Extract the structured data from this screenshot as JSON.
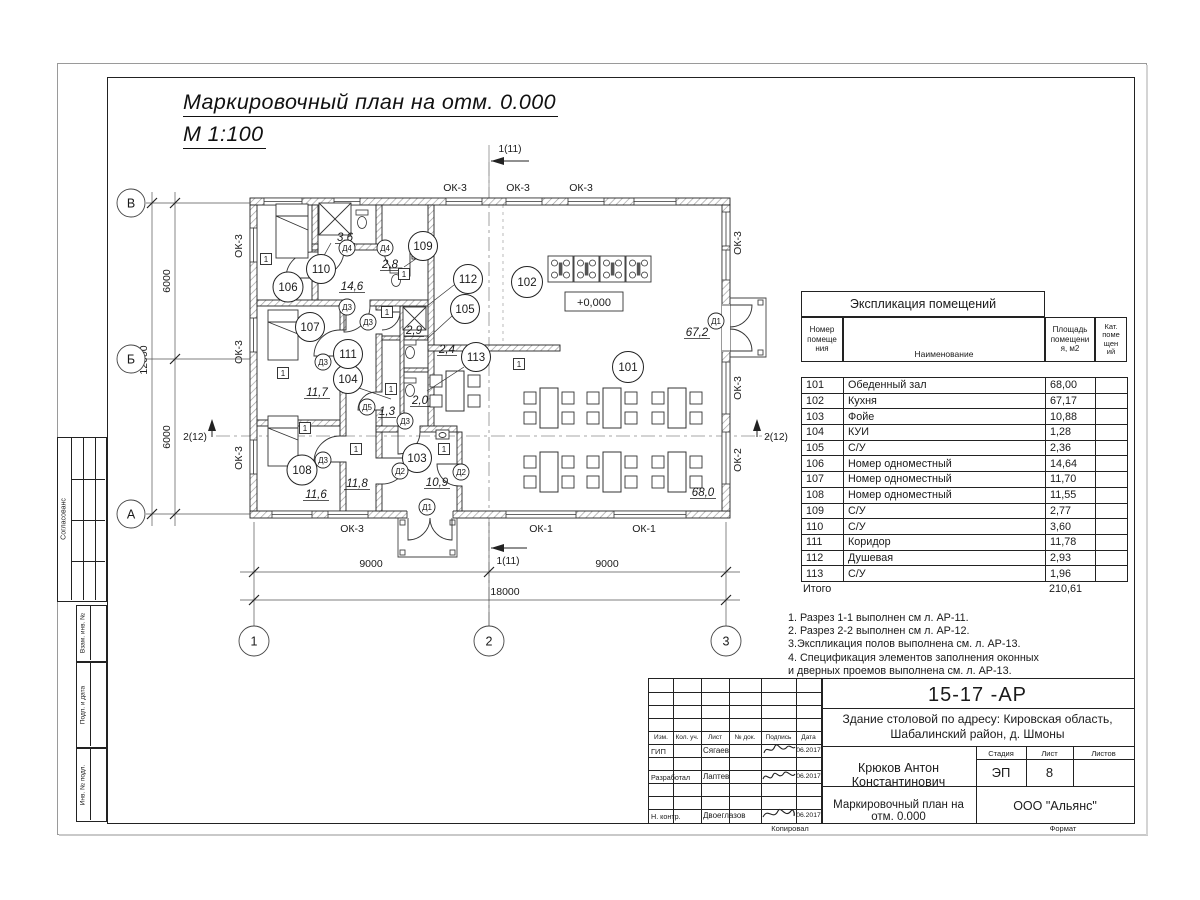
{
  "sheet": {
    "title_line1": "Маркировочный план  на отм. 0.000",
    "title_line2": "М 1:100"
  },
  "explication": {
    "title": "Экспликация помещений",
    "headers": {
      "num": "Номер\nпомеще\nния",
      "name": "Наименование",
      "area": "Площадь\nпомещени\nя, м2",
      "cat": "Кат.\nпоме\nщен\nий"
    },
    "rows": [
      {
        "num": "101",
        "name": "Обеденный зал",
        "area": "68,00"
      },
      {
        "num": "102",
        "name": "Кухня",
        "area": "67,17"
      },
      {
        "num": "103",
        "name": "Фойе",
        "area": "10,88"
      },
      {
        "num": "104",
        "name": "КУИ",
        "area": "1,28"
      },
      {
        "num": "105",
        "name": "С/У",
        "area": "2,36"
      },
      {
        "num": "106",
        "name": "Номер одноместный",
        "area": "14,64"
      },
      {
        "num": "107",
        "name": "Номер одноместный",
        "area": "11,70"
      },
      {
        "num": "108",
        "name": "Номер одноместный",
        "area": "11,55"
      },
      {
        "num": "109",
        "name": "С/У",
        "area": "2,77"
      },
      {
        "num": "110",
        "name": "С/У",
        "area": "3,60"
      },
      {
        "num": "111",
        "name": "Коридор",
        "area": "11,78"
      },
      {
        "num": "112",
        "name": "Душевая",
        "area": "2,93"
      },
      {
        "num": "113",
        "name": "С/У",
        "area": "1,96"
      }
    ],
    "total_label": "Итого",
    "total_value": "210,61"
  },
  "notes": [
    "1. Разрез 1-1 выполнен см л. АР-11.",
    "2. Разрез 2-2 выполнен см л. АР-12.",
    "3.Экспликация полов выполнена  см. л. АР-13.",
    "4. Спецификация элементов заполнения оконных",
    " и дверных проемов выполнена  см. л. АР-13."
  ],
  "plan": {
    "rooms": {
      "r101": {
        "id": "101",
        "area": "68,0"
      },
      "r102": {
        "id": "102",
        "area": "67,2"
      },
      "r103": {
        "id": "103",
        "area": "10,9"
      },
      "r104": {
        "id": "104",
        "area": "1,3"
      },
      "r105": {
        "id": "105",
        "area": "2,4"
      },
      "r106": {
        "id": "106",
        "area": "14,6"
      },
      "r107": {
        "id": "107",
        "area": "11,7"
      },
      "r108": {
        "id": "108",
        "area": "11,6"
      },
      "r109": {
        "id": "109",
        "area": "2,8"
      },
      "r110": {
        "id": "110",
        "area": "3,6"
      },
      "r111": {
        "id": "111",
        "area": "11,8"
      },
      "r112": {
        "id": "112",
        "area": "2,9"
      },
      "r113": {
        "id": "113",
        "area": "2,0"
      }
    },
    "doors": {
      "d1": "Д1",
      "d2": "Д2",
      "d3": "Д3",
      "d4": "Д4",
      "d5": "Д5"
    },
    "windows": {
      "ok1": "ОК-1",
      "ok2": "ОК-2",
      "ok3": "ОК-3"
    },
    "marker": "1",
    "level": "+0,000",
    "dims": {
      "m9000": "9000",
      "m18000": "18000",
      "m6000": "6000",
      "m12000": "12000"
    },
    "axes": {
      "a1": "1",
      "a2": "2",
      "a3": "3",
      "av": "В",
      "ab": "Б",
      "aa": "А"
    },
    "sections": {
      "s1": "1(11)",
      "s2": "2(12)"
    }
  },
  "titleblock": {
    "doc_number": "15-17 -АР",
    "addr1": "Здание столовой по адресу: Кировская область,",
    "addr2": "Шабалинский район, д. Шмоны",
    "cols": [
      "Изм.",
      "Кол. уч.",
      "Лист",
      "№ док.",
      "Подпись",
      "Дата"
    ],
    "roles": [
      {
        "role": "ГИП",
        "name": "Сягаев",
        "date": "06.2017"
      },
      {
        "role": "Разработал",
        "name": "Лаптев",
        "date": "06.2017"
      },
      {
        "role": "Н. контр.",
        "name": "Двоеглазов",
        "date": "06.2017"
      }
    ],
    "author": "Крюков Антон Константинович",
    "stage_label": "Стадия",
    "list_label": "Лист",
    "listov_label": "Листов",
    "stage": "ЭП",
    "list_num": "8",
    "plan_name": "Маркировочный план  на отм. 0.000",
    "company": "ООО \"Альянс\"",
    "copied": "Копировал",
    "format": "Формат"
  },
  "side": {
    "agreed": "Согласованс",
    "i1": "Взам. инв. №",
    "i2": "Подп. и дата",
    "i3": "Инв. № подл."
  }
}
